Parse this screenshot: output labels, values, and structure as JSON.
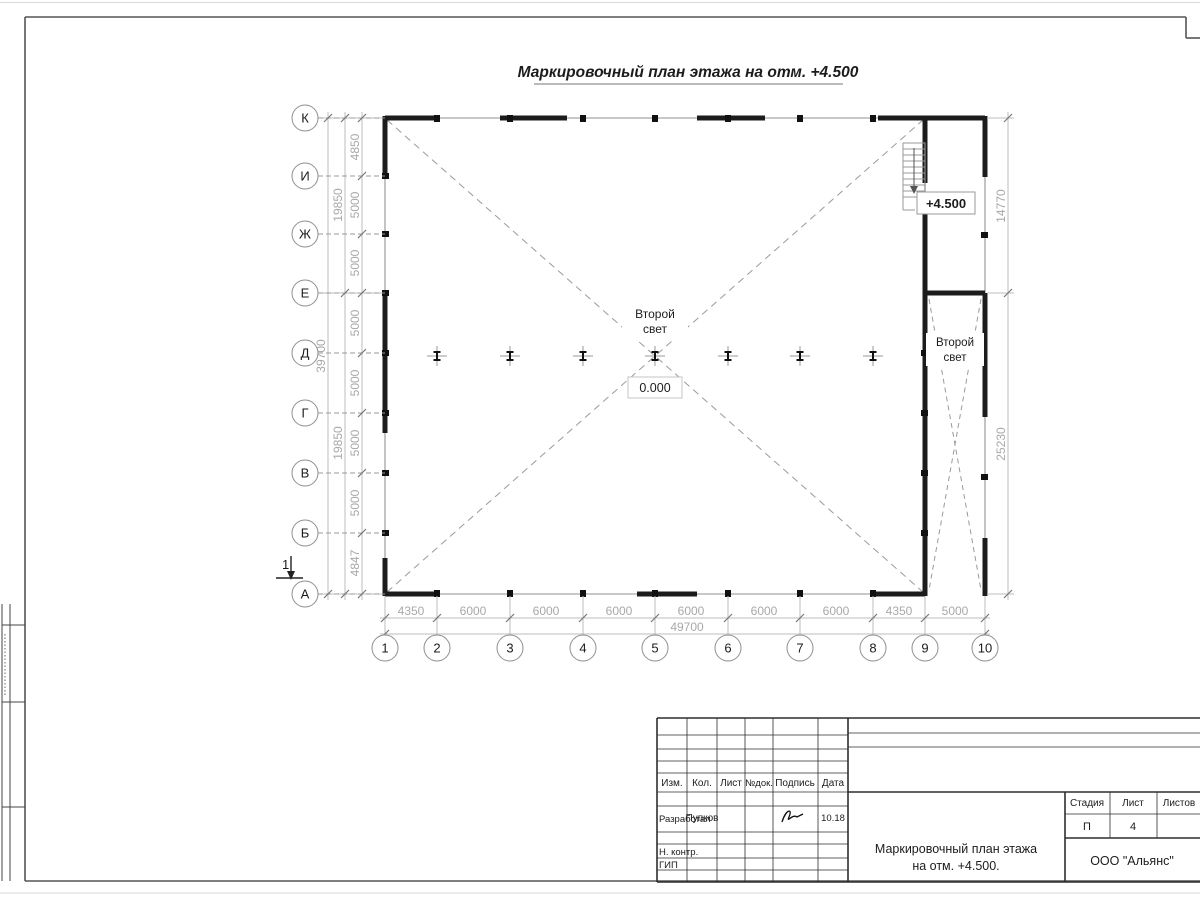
{
  "doc": {
    "title": "Маркировочный план этажа на отм. +4.500"
  },
  "plan": {
    "row_axes": [
      "К",
      "И",
      "Ж",
      "Е",
      "Д",
      "Г",
      "В",
      "Б",
      "А"
    ],
    "col_axes": [
      "1",
      "2",
      "3",
      "4",
      "5",
      "6",
      "7",
      "8",
      "9",
      "10"
    ],
    "left_dims": [
      "4850",
      "5000",
      "5000",
      "5000",
      "5000",
      "5000",
      "5000",
      "4847"
    ],
    "left_subtotals": [
      "19850",
      "19850"
    ],
    "left_total": "39700",
    "bottom_dims": [
      "4350",
      "6000",
      "6000",
      "6000",
      "6000",
      "6000",
      "6000",
      "4350",
      "5000"
    ],
    "bottom_total": "49700",
    "right_dims": [
      "14770",
      "25230"
    ],
    "labels": {
      "second_light_l1": "Второй",
      "second_light_l2": "свет",
      "level_zero": "0.000",
      "level_upper": "+4.500",
      "section_mark": "1"
    }
  },
  "titleblock": {
    "col_izm": "Изм.",
    "col_kol": "Кол.",
    "col_list": "Лист",
    "col_ndok": "№док.",
    "col_podpis": "Подпись",
    "col_data": "Дата",
    "developed_label": "Разработал",
    "developed_name": "Пупков",
    "developed_date": "10.18",
    "ncontr_label": "Н. контр.",
    "gip_label": "ГИП",
    "stage_label": "Стадия",
    "sheet_label": "Лист",
    "sheets_label": "Листов",
    "stage_value": "П",
    "sheet_value": "4",
    "doc_title_l1": "Маркировочный план этажа",
    "doc_title_l2": "на отм. +4.500.",
    "company": "ООО \"Альянс\""
  },
  "colors": {
    "wall": "#1c1c1c",
    "thin_line": "#b5b5b5",
    "dim_text": "#a8a8a8",
    "dashed": "#9a9a9a"
  }
}
